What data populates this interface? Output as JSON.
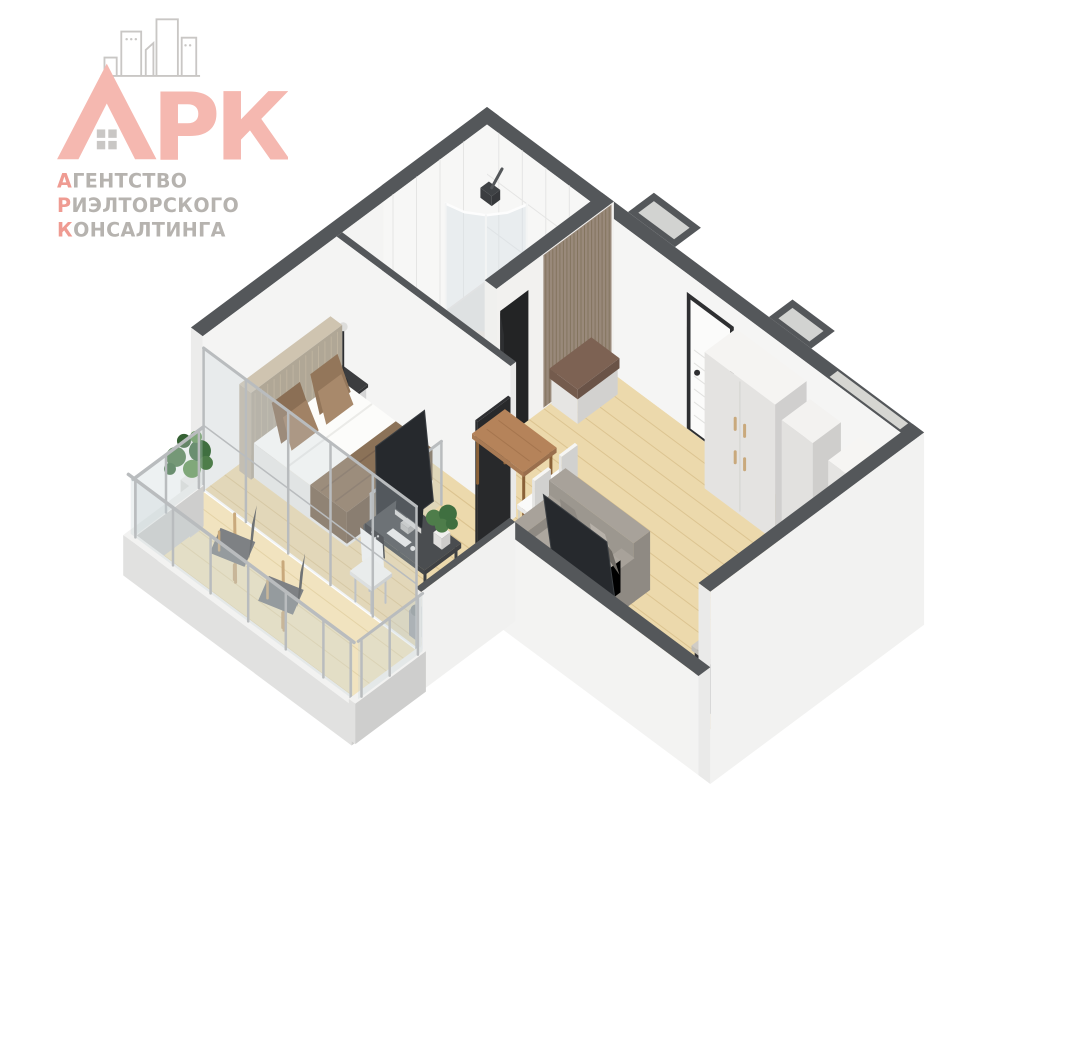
{
  "logo": {
    "brand": "АРК",
    "letters_rk": "РК",
    "line1_initial": "А",
    "line1_rest": "ГЕНТСТВО",
    "line2_initial": "Р",
    "line2_rest": "ИЭЛТОРСКОГО",
    "line3_initial": "К",
    "line3_rest": "ОНСАЛТИНГА"
  },
  "palette": {
    "accent": "#f5b8b0",
    "accent_deep": "#ef9b92",
    "logo_gray": "#b6b3af",
    "icon_gray": "#c9c7c5",
    "wall_top": "#54575a",
    "wall_white": "#f2f2f1",
    "floor_wood": "#ecd9ac",
    "floor_wood_line": "#dcc491",
    "floor_balcony": "#f1e3bf",
    "tile_floor": "#e9e4e0",
    "marble": "#f7f7f6",
    "marble_line": "#e5e5e4",
    "slat_panel": "#99897a",
    "bench_cushion": "#7d6253",
    "sofa": "#a8a29a",
    "headboard": "#cfc4b0",
    "throw": "#8b7258",
    "counter_base": "#2c2c2f",
    "granite": "#d0ccc6",
    "dark_tile": "#303234",
    "tv": "#26292d",
    "desk": "#4a4d50",
    "glass": "rgba(198,210,216,0.32)",
    "metal": "#b9bcbe",
    "plant": "#4e7d4a",
    "chair_fabric": "#7e8184",
    "chair_wood": "#c9a97c",
    "door_frame": "#2e2f31",
    "door_leaf": "#fbfbfa",
    "table_wood": "#b5835a"
  },
  "scene": {
    "type": "isometric-3d-floorplan-render",
    "rooms": [
      {
        "name": "bathroom",
        "furniture": [
          "shower-cabin",
          "washing-machine",
          "toilet",
          "bath-mat",
          "marble-walls"
        ]
      },
      {
        "name": "hallway",
        "furniture": [
          "entrance-door",
          "wood-slat-panel",
          "bench",
          "wardrobe",
          "cabinet",
          "fridge",
          "dark-tile-floor"
        ]
      },
      {
        "name": "kitchen",
        "furniture": [
          "counter",
          "sink",
          "faucet",
          "cooktop"
        ]
      },
      {
        "name": "living-room",
        "furniture": [
          "dining-table",
          "white-chairs",
          "sofa",
          "tv"
        ]
      },
      {
        "name": "bedroom",
        "furniture": [
          "double-bed",
          "headboard",
          "nightstand",
          "lamp",
          "tv",
          "desk",
          "computer",
          "desk-chair",
          "waste-bin",
          "sliding-door"
        ]
      },
      {
        "name": "balcony",
        "furniture": [
          "glass-railing",
          "potted-plant",
          "stool",
          "lounge-chair",
          "lounge-chair"
        ]
      }
    ]
  }
}
